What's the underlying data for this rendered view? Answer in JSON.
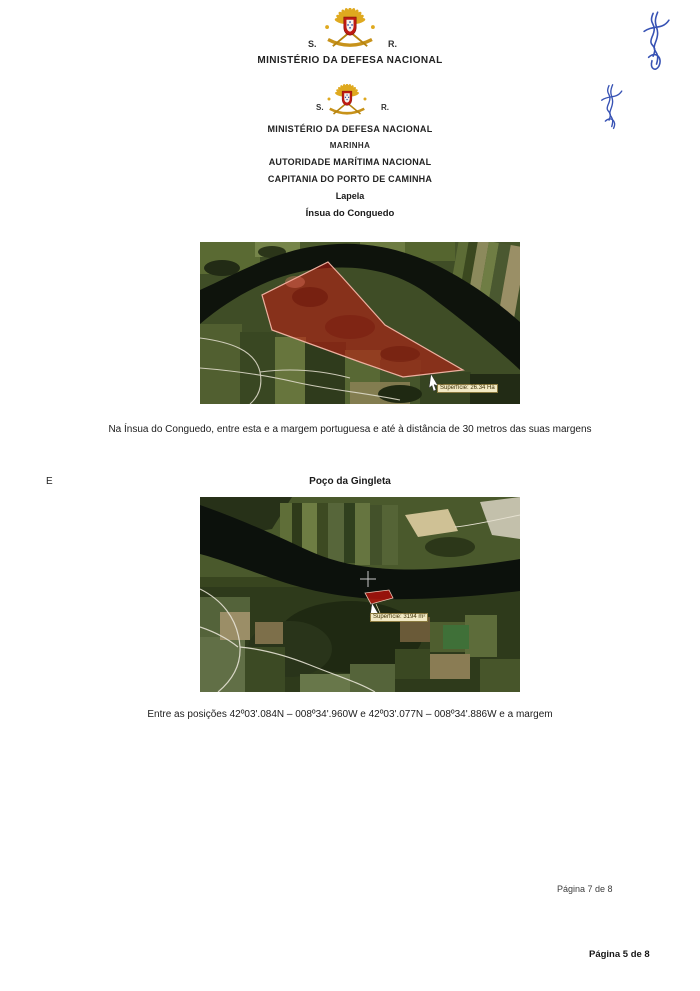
{
  "document": {
    "header1": {
      "s": "S.",
      "r": "R.",
      "title": "MINISTÉRIO DA DEFESA NACIONAL"
    },
    "header2": {
      "s": "S.",
      "r": "R.",
      "title": "MINISTÉRIO DA DEFESA NACIONAL",
      "marinha": "MARINHA",
      "autoridade": "AUTORIDADE MARÍTIMA NACIONAL",
      "capitania": "CAPITANIA DO PORTO DE CAMINHA"
    },
    "section1": {
      "place": "Lapela",
      "site": "Ínsua do Conguedo",
      "surface_label": "Superfície: 26.34 Ha",
      "caption": "Na Ínsua do Conguedo, entre esta e a margem portuguesa e até à distância de 30 metros das suas margens"
    },
    "margin_mark": "E",
    "section2": {
      "site": "Poço da Gingleta",
      "surface_label": "Superfície: 3194 m²",
      "caption": "Entre as posições 42º03'.084N – 008º34'.960W e 42º03'.077N – 008º34'.886W e a margem"
    },
    "footer": {
      "page_note": "Página 7 de 8",
      "page_number": "Página 5 de 8"
    }
  },
  "colors": {
    "highlight_red": "#c0241a",
    "river_dark": "#0e130c",
    "label_beige": "#f2e9c4",
    "signature_ink": "#3752b4",
    "crest_gold": "#dfa91f",
    "crest_shield_red": "#bf1a12"
  }
}
